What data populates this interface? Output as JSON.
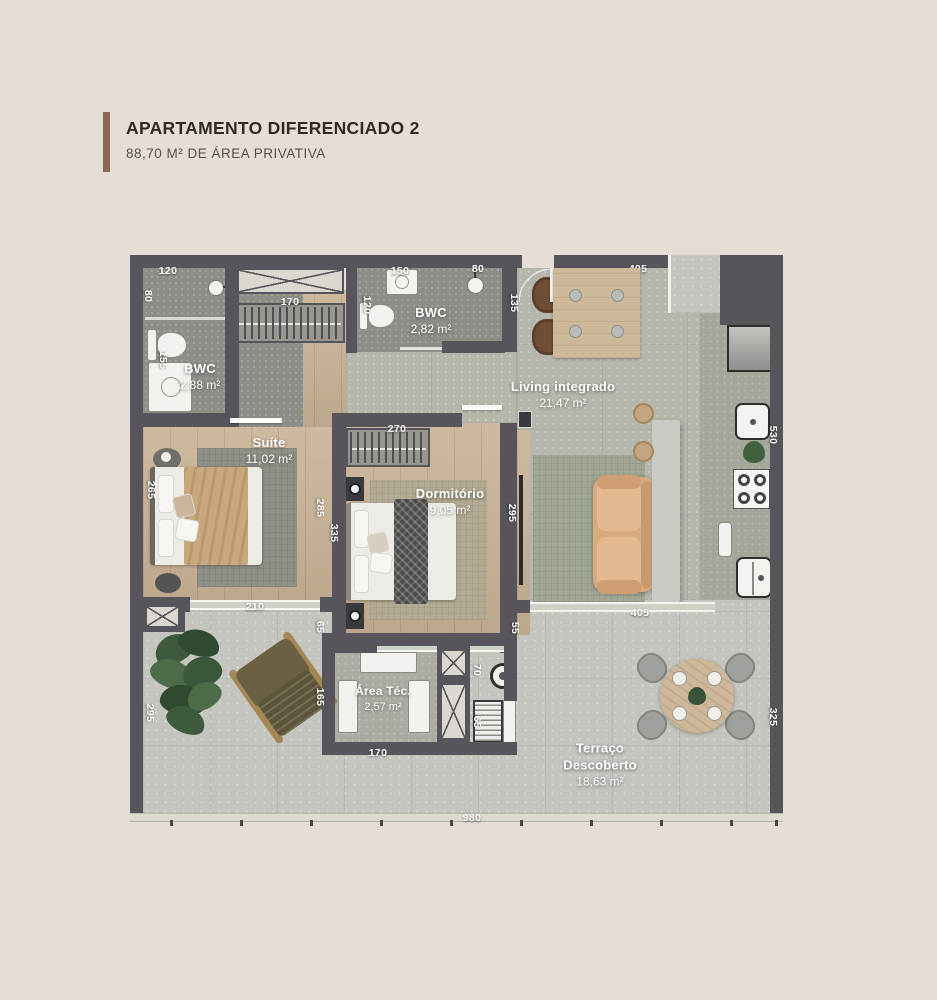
{
  "header": {
    "title": "APARTAMENTO DIFERENCIADO 2",
    "subtitle": "88,70 M² DE ÁREA PRIVATIVA"
  },
  "colors": {
    "background": "#e6ddd6",
    "accent_bar": "#8e6753",
    "wall": "#57555b",
    "wood_floor": "#c9b295",
    "bath_floor": "#8d8e87",
    "living_floor": "#b5b7ac",
    "terrace_floor": "#c4c5bf",
    "label_text": "#ffffff"
  },
  "rooms": [
    {
      "name": "BWC",
      "area": "2,88 m²"
    },
    {
      "name": "BWC",
      "area": "2,82 m²"
    },
    {
      "name": "Suíte",
      "area": "11,02 m²"
    },
    {
      "name": "Dormitório",
      "area": "9,05 m²"
    },
    {
      "name": "Living integrado",
      "area": "21,47 m²"
    },
    {
      "name": "Área Téc.",
      "area": "2,57 m²"
    },
    {
      "name": "Terraço Descoberto",
      "area": "18,63 m²"
    }
  ],
  "dimensions_cm": [
    {
      "value": "120",
      "x": 38,
      "y": 16,
      "rot": 0
    },
    {
      "value": "80",
      "x": 18,
      "y": 41,
      "rot": 90
    },
    {
      "value": "155",
      "x": 33,
      "y": 105,
      "rot": 90
    },
    {
      "value": "170",
      "x": 160,
      "y": 47,
      "rot": 0
    },
    {
      "value": "150",
      "x": 270,
      "y": 16,
      "rot": 0
    },
    {
      "value": "80",
      "x": 348,
      "y": 14,
      "rot": 0
    },
    {
      "value": "405",
      "x": 508,
      "y": 14,
      "rot": 0
    },
    {
      "value": "120",
      "x": 237,
      "y": 50,
      "rot": 90
    },
    {
      "value": "135",
      "x": 384,
      "y": 48,
      "rot": 90
    },
    {
      "value": "530",
      "x": 643,
      "y": 180,
      "rot": 90
    },
    {
      "value": "270",
      "x": 267,
      "y": 174,
      "rot": 0
    },
    {
      "value": "265",
      "x": 21,
      "y": 235,
      "rot": 90
    },
    {
      "value": "285",
      "x": 190,
      "y": 253,
      "rot": 90
    },
    {
      "value": "335",
      "x": 204,
      "y": 278,
      "rot": 90
    },
    {
      "value": "295",
      "x": 382,
      "y": 258,
      "rot": 90
    },
    {
      "value": "210",
      "x": 125,
      "y": 352,
      "rot": 0
    },
    {
      "value": "65",
      "x": 190,
      "y": 372,
      "rot": 90
    },
    {
      "value": "55",
      "x": 385,
      "y": 373,
      "rot": 90
    },
    {
      "value": "405",
      "x": 510,
      "y": 358,
      "rot": 0
    },
    {
      "value": "295",
      "x": 20,
      "y": 458,
      "rot": 90
    },
    {
      "value": "165",
      "x": 190,
      "y": 442,
      "rot": 90
    },
    {
      "value": "70",
      "x": 347,
      "y": 415,
      "rot": 90
    },
    {
      "value": "65",
      "x": 347,
      "y": 467,
      "rot": 90
    },
    {
      "value": "170",
      "x": 248,
      "y": 498,
      "rot": 0
    },
    {
      "value": "325",
      "x": 643,
      "y": 462,
      "rot": 90
    },
    {
      "value": "980",
      "x": 342,
      "y": 563,
      "rot": 0
    }
  ]
}
